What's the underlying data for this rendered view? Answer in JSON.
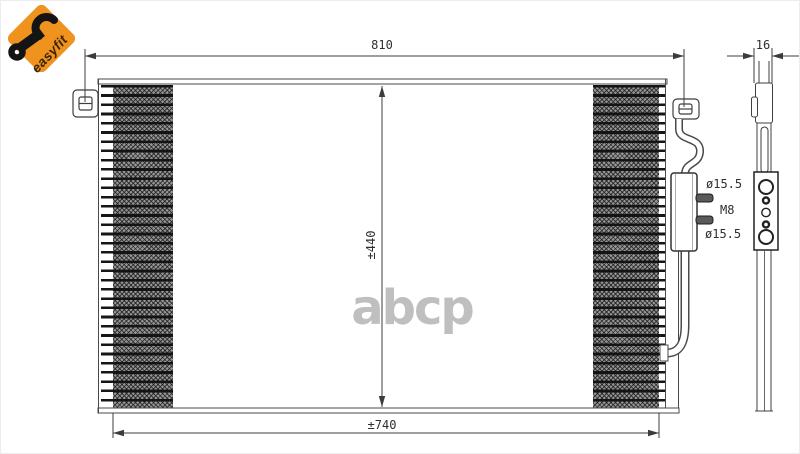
{
  "badge": {
    "label": "easyfit",
    "icon": "wrench-icon",
    "accent_color": "#F0921E"
  },
  "watermark": {
    "text": "abcp",
    "color": "#B5B5B5"
  },
  "diagram": {
    "subject": "air-conditioning condenser technical drawing, front view and side view",
    "line_color": "#3C3C3C",
    "front_view": {
      "overall_width_label": "810",
      "core_height_label": "±440",
      "core_width_label": "±740"
    },
    "side_view": {
      "depth_label": "16",
      "upper_port_label": "ø15.5",
      "thread_label": "M8",
      "lower_port_label": "ø15.5"
    }
  }
}
